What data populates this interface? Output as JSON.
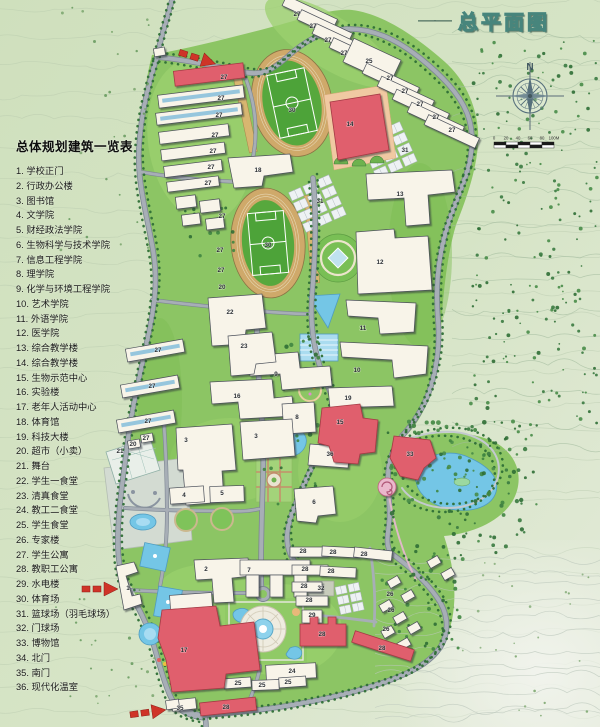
{
  "title": {
    "dash": "——",
    "text": "总平面图"
  },
  "compass": {
    "north_label": "N"
  },
  "scalebar": {
    "labels": [
      "0",
      "20",
      "40",
      "60",
      "80",
      "100M"
    ]
  },
  "legend": {
    "title": "总体规划建筑一览表",
    "items": [
      {
        "num": "1",
        "label": "学校正门"
      },
      {
        "num": "2",
        "label": "行政办公楼"
      },
      {
        "num": "3",
        "label": "图书馆"
      },
      {
        "num": "4",
        "label": "文学院"
      },
      {
        "num": "5",
        "label": "财经政法学院"
      },
      {
        "num": "6",
        "label": "生物科学与技术学院"
      },
      {
        "num": "7",
        "label": "信息工程学院"
      },
      {
        "num": "8",
        "label": "理学院"
      },
      {
        "num": "9",
        "label": "化学与环境工程学院"
      },
      {
        "num": "10",
        "label": "艺术学院"
      },
      {
        "num": "11",
        "label": "外语学院"
      },
      {
        "num": "12",
        "label": "医学院"
      },
      {
        "num": "13",
        "label": "综合教学楼"
      },
      {
        "num": "14",
        "label": "综合教学楼"
      },
      {
        "num": "15",
        "label": "生物示范中心"
      },
      {
        "num": "16",
        "label": "实验楼"
      },
      {
        "num": "17",
        "label": "老年人活动中心"
      },
      {
        "num": "18",
        "label": "体育馆"
      },
      {
        "num": "19",
        "label": "科技大楼"
      },
      {
        "num": "20",
        "label": "超市（小卖）"
      },
      {
        "num": "21",
        "label": "舞台"
      },
      {
        "num": "22",
        "label": "学生一食堂"
      },
      {
        "num": "23",
        "label": "清真食堂"
      },
      {
        "num": "24",
        "label": "教工二食堂"
      },
      {
        "num": "25",
        "label": "学生食堂"
      },
      {
        "num": "26",
        "label": "专家楼"
      },
      {
        "num": "27",
        "label": "学生公寓"
      },
      {
        "num": "28",
        "label": "教职工公寓"
      },
      {
        "num": "29",
        "label": "水电楼"
      },
      {
        "num": "30",
        "label": "体育场"
      },
      {
        "num": "31",
        "label": "篮球场（羽毛球场）"
      },
      {
        "num": "32",
        "label": "门球场"
      },
      {
        "num": "33",
        "label": "博物馆"
      },
      {
        "num": "34",
        "label": "北门"
      },
      {
        "num": "35",
        "label": "南门"
      },
      {
        "num": "36",
        "label": "现代化温室"
      }
    ]
  },
  "map": {
    "labels": [
      {
        "t": "27",
        "x": 224,
        "y": 79
      },
      {
        "t": "27",
        "x": 221,
        "y": 100
      },
      {
        "t": "27",
        "x": 219,
        "y": 117
      },
      {
        "t": "27",
        "x": 215,
        "y": 137
      },
      {
        "t": "27",
        "x": 213,
        "y": 153
      },
      {
        "t": "27",
        "x": 211,
        "y": 169
      },
      {
        "t": "27",
        "x": 208,
        "y": 185
      },
      {
        "t": "27",
        "x": 297,
        "y": 16
      },
      {
        "t": "27",
        "x": 313,
        "y": 28
      },
      {
        "t": "27",
        "x": 328,
        "y": 42
      },
      {
        "t": "27",
        "x": 344,
        "y": 55
      },
      {
        "t": "25",
        "x": 369,
        "y": 63
      },
      {
        "t": "27",
        "x": 390,
        "y": 80
      },
      {
        "t": "27",
        "x": 405,
        "y": 93
      },
      {
        "t": "27",
        "x": 420,
        "y": 106
      },
      {
        "t": "27",
        "x": 436,
        "y": 119
      },
      {
        "t": "27",
        "x": 452,
        "y": 132
      },
      {
        "t": "30",
        "x": 292,
        "y": 112
      },
      {
        "t": "14",
        "x": 350,
        "y": 126
      },
      {
        "t": "31",
        "x": 405,
        "y": 152
      },
      {
        "t": "18",
        "x": 258,
        "y": 172
      },
      {
        "t": "13",
        "x": 400,
        "y": 196
      },
      {
        "t": "31",
        "x": 320,
        "y": 203
      },
      {
        "t": "30",
        "x": 268,
        "y": 247
      },
      {
        "t": "12",
        "x": 380,
        "y": 264
      },
      {
        "t": "27",
        "x": 222,
        "y": 218
      },
      {
        "t": "27",
        "x": 220,
        "y": 252
      },
      {
        "t": "27",
        "x": 221,
        "y": 272
      },
      {
        "t": "20",
        "x": 222,
        "y": 289
      },
      {
        "t": "22",
        "x": 230,
        "y": 314
      },
      {
        "t": "11",
        "x": 363,
        "y": 330
      },
      {
        "t": "23",
        "x": 244,
        "y": 348
      },
      {
        "t": "27",
        "x": 158,
        "y": 352
      },
      {
        "t": "27",
        "x": 152,
        "y": 388
      },
      {
        "t": "27",
        "x": 148,
        "y": 423
      },
      {
        "t": "9",
        "x": 276,
        "y": 376
      },
      {
        "t": "10",
        "x": 357,
        "y": 372
      },
      {
        "t": "16",
        "x": 237,
        "y": 398
      },
      {
        "t": "19",
        "x": 348,
        "y": 400
      },
      {
        "t": "8",
        "x": 297,
        "y": 419
      },
      {
        "t": "15",
        "x": 340,
        "y": 424
      },
      {
        "t": "3",
        "x": 186,
        "y": 442
      },
      {
        "t": "3",
        "x": 256,
        "y": 438
      },
      {
        "t": "36",
        "x": 330,
        "y": 456
      },
      {
        "t": "33",
        "x": 410,
        "y": 456
      },
      {
        "t": "27",
        "x": 146,
        "y": 440
      },
      {
        "t": "20",
        "x": 133,
        "y": 446
      },
      {
        "t": "21",
        "x": 120,
        "y": 453
      },
      {
        "t": "4",
        "x": 184,
        "y": 497
      },
      {
        "t": "5",
        "x": 222,
        "y": 495
      },
      {
        "t": "6",
        "x": 314,
        "y": 504
      },
      {
        "t": "1",
        "x": 128,
        "y": 590
      },
      {
        "t": "2",
        "x": 206,
        "y": 571
      },
      {
        "t": "7",
        "x": 249,
        "y": 572
      },
      {
        "t": "28",
        "x": 303,
        "y": 553
      },
      {
        "t": "28",
        "x": 333,
        "y": 554
      },
      {
        "t": "28",
        "x": 364,
        "y": 556
      },
      {
        "t": "28",
        "x": 305,
        "y": 571
      },
      {
        "t": "28",
        "x": 331,
        "y": 573
      },
      {
        "t": "28",
        "x": 304,
        "y": 588
      },
      {
        "t": "32",
        "x": 321,
        "y": 590
      },
      {
        "t": "28",
        "x": 309,
        "y": 602
      },
      {
        "t": "29",
        "x": 312,
        "y": 617
      },
      {
        "t": "26",
        "x": 390,
        "y": 596
      },
      {
        "t": "26",
        "x": 391,
        "y": 612
      },
      {
        "t": "26",
        "x": 386,
        "y": 631
      },
      {
        "t": "28",
        "x": 322,
        "y": 636
      },
      {
        "t": "28",
        "x": 382,
        "y": 650
      },
      {
        "t": "17",
        "x": 184,
        "y": 652
      },
      {
        "t": "24",
        "x": 292,
        "y": 673
      },
      {
        "t": "25",
        "x": 238,
        "y": 685
      },
      {
        "t": "25",
        "x": 262,
        "y": 687
      },
      {
        "t": "25",
        "x": 288,
        "y": 684
      },
      {
        "t": "35",
        "x": 180,
        "y": 710
      },
      {
        "t": "28",
        "x": 226,
        "y": 709
      }
    ]
  },
  "colors": {
    "campus_green": "#8cc564",
    "building_red": "#e05f6d",
    "water_blue": "#74c6e6",
    "road_gray": "#a7aeb6",
    "track_tan": "#cfa96a"
  }
}
